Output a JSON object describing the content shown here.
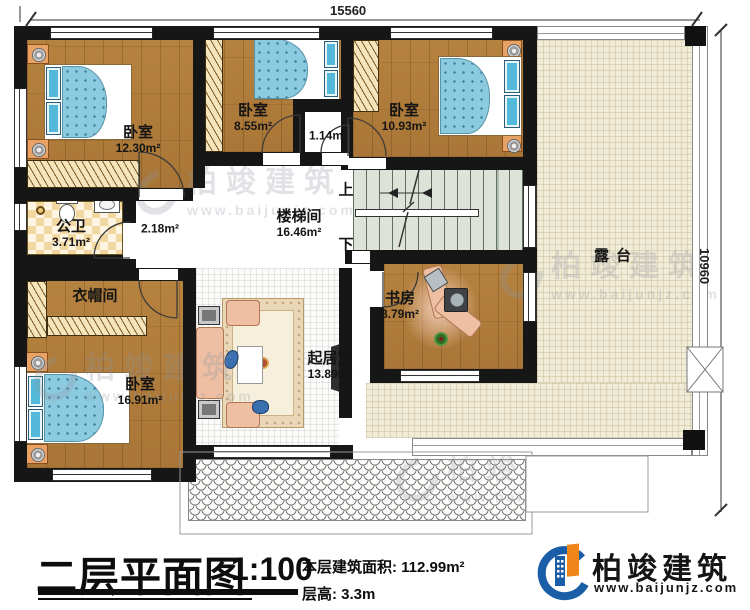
{
  "drawing": {
    "dim_top": "15560",
    "dim_right": "10960"
  },
  "rooms": {
    "bedroom_top_left": {
      "name": "卧室",
      "area": "12.30m²"
    },
    "bedroom_top_mid": {
      "name": "卧室",
      "area": "8.55m²"
    },
    "bedroom_top_right": {
      "name": "卧室",
      "area": "10.93m²"
    },
    "closet_small": {
      "area": "1.14m²"
    },
    "hall": {
      "area": "2.18m²"
    },
    "stairwell": {
      "name": "楼梯间",
      "area": "16.46m²"
    },
    "bathroom": {
      "name": "公卫",
      "area": "3.71m²"
    },
    "cloakroom": {
      "name": "衣帽间"
    },
    "bedroom_bottom_left": {
      "name": "卧室",
      "area": "16.91m²"
    },
    "living": {
      "name": "起居室",
      "area": "13.89m²"
    },
    "study": {
      "name": "书房",
      "area": "8.79m²"
    },
    "terrace": {
      "name": "露台"
    }
  },
  "stairs": {
    "up": "上",
    "down": "下"
  },
  "title_block": {
    "title": "二层平面图",
    "scale": "1:100",
    "floor_area_label": "本层建筑面积:",
    "floor_area_value": "112.99m²",
    "floor_height_label": "层高:",
    "floor_height_value": "3.3m"
  },
  "brand": {
    "name": "柏竣建筑",
    "website": "www.baijunjz.com"
  },
  "watermark": {
    "name": "柏竣建筑",
    "website": "www.baijunjz.com"
  },
  "colors": {
    "wall": "#161616",
    "wood_floor": "#b0803e",
    "terrace": "#f1ecd7",
    "stair": "#dde3d9",
    "bed_blanket": "#8ccbdf",
    "logo_blue": "#1b5ea8",
    "logo_orange": "#f08519"
  }
}
